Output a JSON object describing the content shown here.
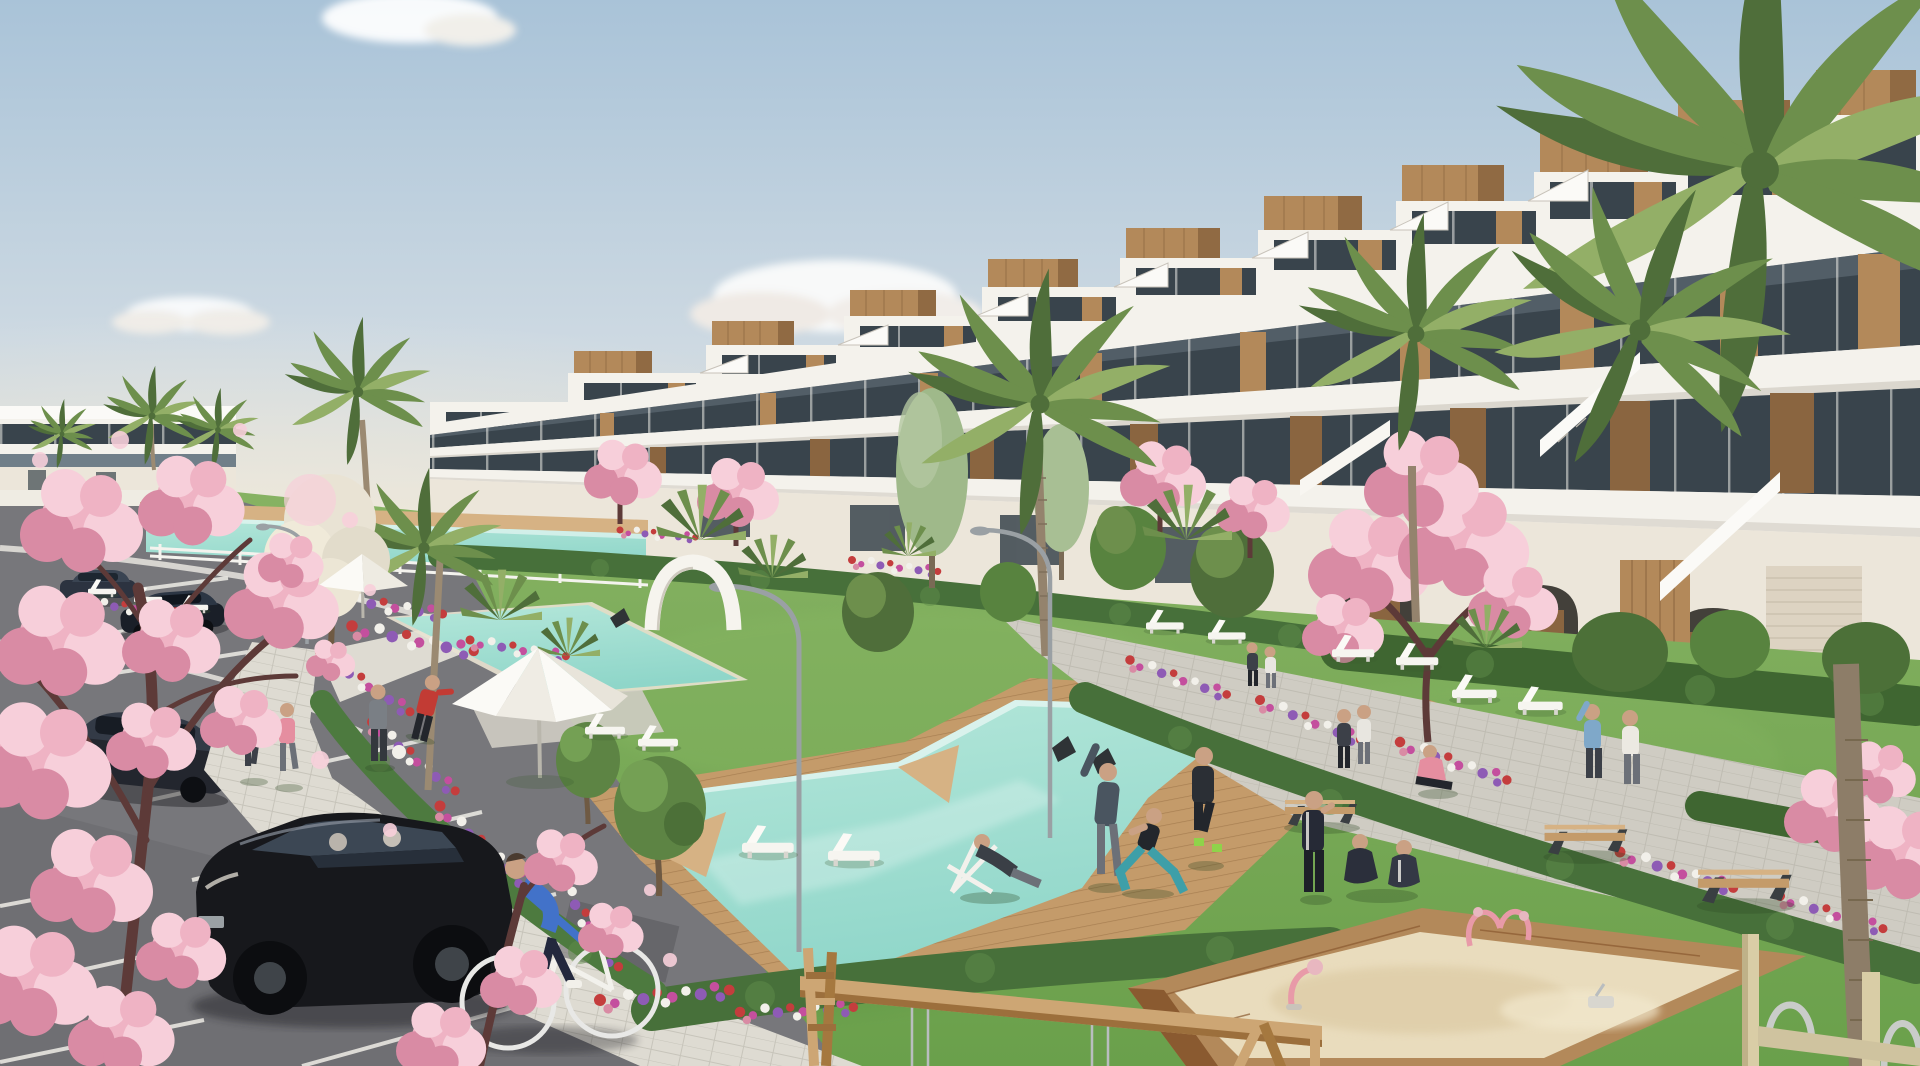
{
  "meta": {
    "type": "architectural-render",
    "description": "Sunny 3D architectural rendering of a modern white Mediterranean apartment complex with wooden accents, stepped roof terraces, landscaped gardens with palm and cherry-blossom trees, three turquoise swimming pools with wooden decks, sun loungers and parasols, a parking lot with cars, a cyclist, joggers and people exercising on the lawn, a children's sandbox with pink play equipment and a wooden swing frame in the foreground",
    "width": 1920,
    "height": 1066
  },
  "palette": {
    "sky_top": "#a9c3d8",
    "sky_mid": "#cdd9e2",
    "sky_horizon": "#ece4d5",
    "cloud": "#ffffff",
    "building_white": "#f4f2ec",
    "building_cream": "#ece6da",
    "building_shadow": "#d8d2c8",
    "glass_dark": "#39444c",
    "glass_mid": "#707f89",
    "wood": "#b3895a",
    "wood_dark": "#8a6540",
    "wood_light": "#cda674",
    "palm_dark": "#4f6e3a",
    "palm_mid": "#6d8f4c",
    "palm_light": "#93af67",
    "grass": "#74a854",
    "grass_light": "#8abb66",
    "grass_shadow": "#578b41",
    "hedge": "#47703a",
    "hedge_light": "#5f8c4a",
    "blossom": "#efb3c4",
    "blossom_light": "#f7cfda",
    "blossom_dark": "#d98ba4",
    "branch": "#5d3a38",
    "flower_red": "#c43d3d",
    "flower_magenta": "#c44f9e",
    "flower_purple": "#8e5bb5",
    "flower_white": "#f2f0ea",
    "pool": "#8fd6c9",
    "pool_light": "#b5e7da",
    "deck": "#c49b6a",
    "deck_light": "#d6b284",
    "deck_dark": "#a87f4f",
    "path": "#cfccc3",
    "path_light": "#dedbd2",
    "asphalt": "#77777b",
    "line_white": "#eceae6",
    "car_black": "#17181c",
    "metal_gray": "#9aa0a4",
    "sand": "#e9dcbd",
    "skin": "#caa184"
  },
  "scene": {
    "sky": {
      "weather": "clear with scattered white clouds",
      "cloud_count": 4
    },
    "buildings": [
      {
        "name": "main-apartment-block",
        "style": "white modern terraced block, 3-4 stories, stepped rooftop terraces with wooden storage boxes and stairs, dark glass bands, vertical wood slat panels, arched ground-floor openings"
      },
      {
        "name": "distant-low-rise",
        "style": "white two-story block at far left with dark glazing band"
      }
    ],
    "pools": [
      {
        "name": "back-pool",
        "shape": "narrow diagonal lap strip"
      },
      {
        "name": "middle-pool",
        "shape": "small slanted basin"
      },
      {
        "name": "main-pool",
        "shape": "large angular Z-shaped pool with wooden deck and step wedges"
      }
    ],
    "vegetation": {
      "palm_trees": 12,
      "cherry_blossom_trees": 8,
      "green_trees": 10,
      "hedges": "trimmed hedge bands along paths, lawn and building base",
      "flower_beds": "mixed red, magenta, purple and white flowers along walkways and pools"
    },
    "amenities": {
      "sun_loungers": 13,
      "parasols": 2,
      "curved_street_lamps": 3,
      "park_benches": 3,
      "garden_chairs": 3,
      "white_garden_arch": 1,
      "bike_racks": 2
    },
    "playground": {
      "sandbox": "large wooden-framed sand pit",
      "equipment": [
        "pink spring rider",
        "pink climber",
        "wooden swing frame with chains"
      ]
    },
    "vehicles": [
      {
        "name": "black-hatchback",
        "state": "parked in foreground stall, two occupants"
      },
      {
        "name": "dark-sedan-1",
        "state": "parked upper lot"
      },
      {
        "name": "dark-sedan-2",
        "state": "parked upper lot"
      },
      {
        "name": "dark-sedan-3",
        "state": "driving through lot"
      }
    ],
    "people": [
      {
        "role": "jogger",
        "top_color": "teal"
      },
      {
        "role": "jogger",
        "top_color": "pink"
      },
      {
        "role": "man-with-football",
        "top_color": "gray"
      },
      {
        "role": "man-reaching",
        "top_color": "red"
      },
      {
        "role": "cyclist",
        "top_color": "blue"
      },
      {
        "role": "man-stretching",
        "top_color": "dark gray"
      },
      {
        "role": "woman-lunging",
        "top_color": "black, teal leggings"
      },
      {
        "role": "man-jogging",
        "top_color": "black"
      },
      {
        "role": "man-on-deck-chair",
        "top_color": "dark"
      },
      {
        "role": "man-photographing",
        "top_color": "navy tracksuit"
      },
      {
        "role": "two-seated-on-grass",
        "top_color": "dark tracksuits"
      },
      {
        "role": "two-walkers-on-path",
        "top_color": "dark / white"
      },
      {
        "role": "seated-girl",
        "top_color": "pink"
      },
      {
        "role": "pair-by-loungers",
        "top_color": "dark / white"
      },
      {
        "role": "pair-near-building",
        "top_color": "light blue / white"
      }
    ],
    "ground": {
      "parking": "gray asphalt lot with white stall lines, lower left",
      "sidewalk": "light paver path between parking and gardens",
      "promenade": "wide paver walkway along building with benches",
      "lawns": "large sunlit lawns"
    }
  }
}
